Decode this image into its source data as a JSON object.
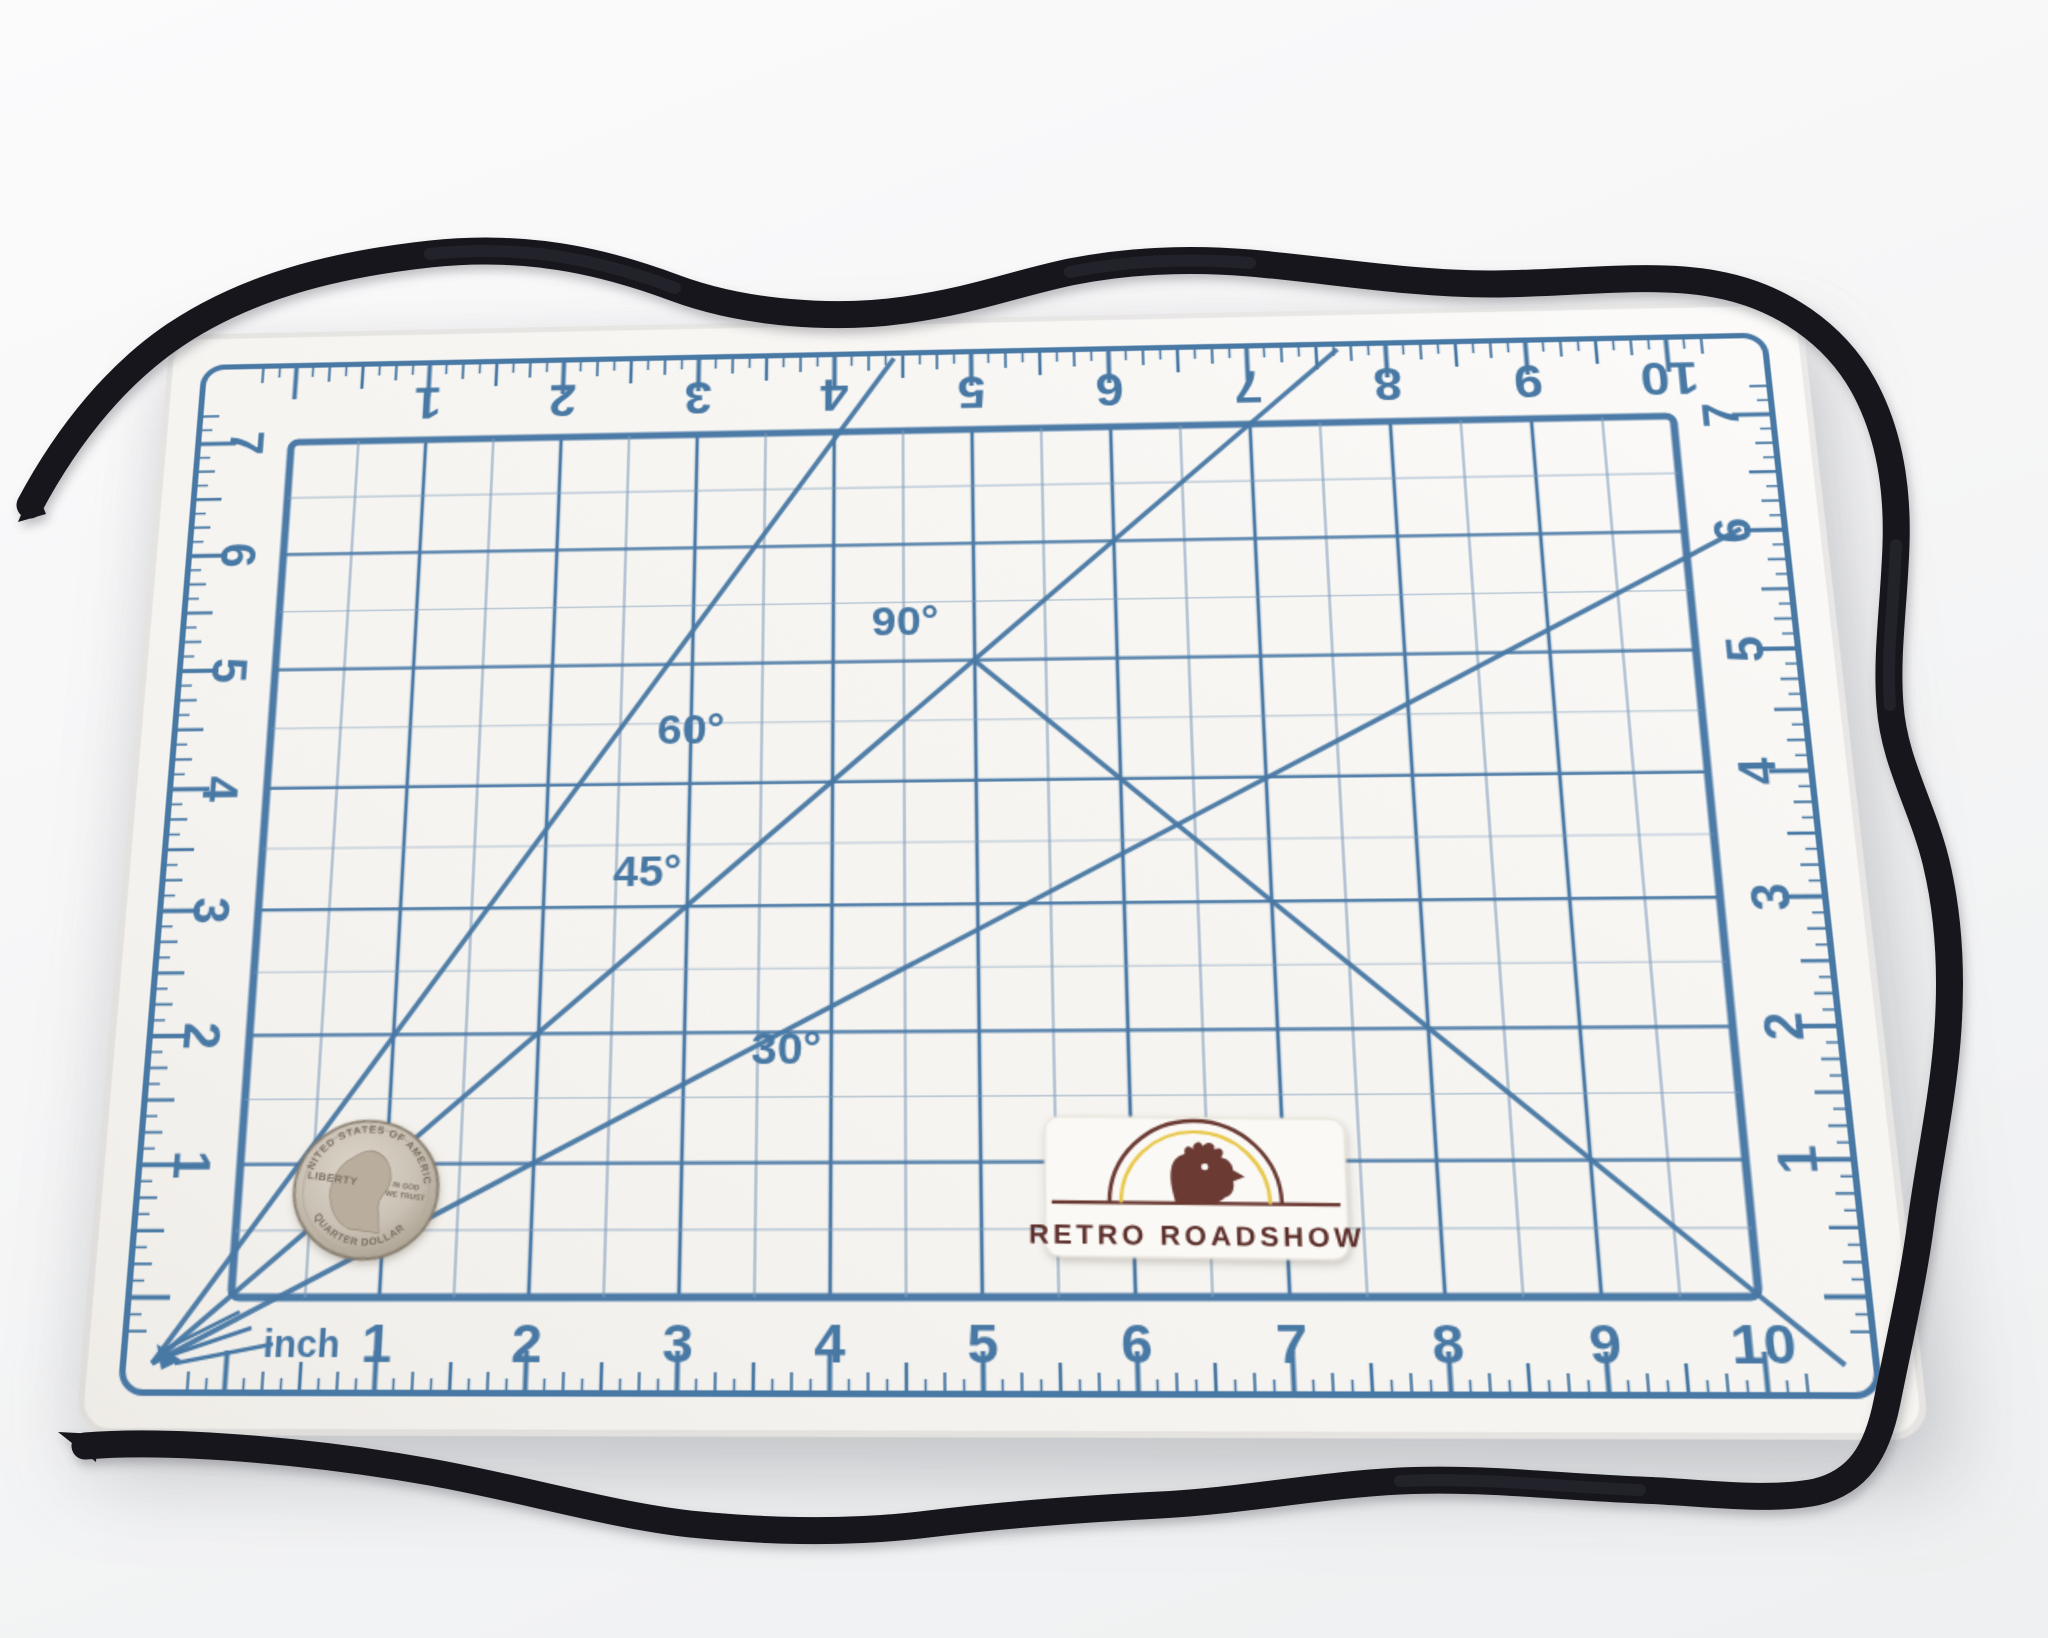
{
  "mat": {
    "unit_label": "inch",
    "bottom_numbers": [
      "1",
      "2",
      "3",
      "4",
      "5",
      "6",
      "7",
      "8",
      "9",
      "10"
    ],
    "top_numbers": [
      "1",
      "2",
      "3",
      "4",
      "5",
      "6",
      "7",
      "8",
      "9",
      "10"
    ],
    "left_numbers": [
      "7",
      "6",
      "5",
      "4",
      "3",
      "2",
      "1"
    ],
    "right_numbers": [
      "7",
      "6",
      "5",
      "4",
      "3",
      "2",
      "1"
    ],
    "angle_labels": [
      "30°",
      "45°",
      "60°",
      "90°"
    ],
    "inches_wide": 10,
    "inches_high": 7,
    "ink_color": "#4878a4",
    "grid_line_color": "#4d7ba7",
    "half_line_color": "#7d9cbb",
    "surface_color": "#f6f4f0"
  },
  "label_plate": {
    "brand": "RETRO ROADSHOW",
    "text_color": "#5c2f2c",
    "arch_color": "#6b3a33",
    "arc_accent_color": "#e8c94f",
    "background_color": "#fbf9f5"
  },
  "coin": {
    "top_text": "UNITED STATES OF AMERICA",
    "left_text": "LIBERTY",
    "right_text_line1": "IN GOD",
    "right_text_line2": "WE TRUST",
    "bottom_text": "QUARTER DOLLAR",
    "metal_color": "#c9c1b4"
  },
  "cord": {
    "color": "#17171c",
    "hardware_color": "#c79d72"
  }
}
